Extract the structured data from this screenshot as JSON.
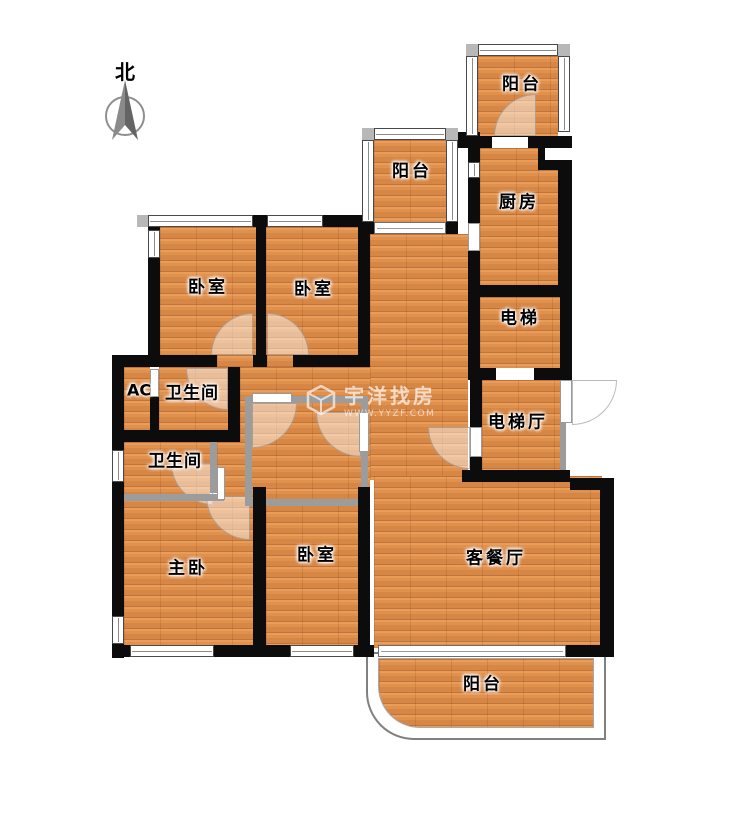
{
  "compass": {
    "label": "北"
  },
  "watermark": {
    "brand": "宇洋找房",
    "url": "WWW.YYZF.COM"
  },
  "rooms": {
    "balcony_top": {
      "label": "阳台"
    },
    "balcony_mid": {
      "label": "阳台"
    },
    "kitchen": {
      "label": "厨房"
    },
    "bedroom_left": {
      "label": "卧室"
    },
    "bedroom_mid": {
      "label": "卧室"
    },
    "elevator": {
      "label": "电梯"
    },
    "elevator_hall": {
      "label": "电梯厅"
    },
    "ac": {
      "label": "AC"
    },
    "bathroom_top": {
      "label": "卫生间"
    },
    "bathroom_bottom": {
      "label": "卫生间"
    },
    "master_bedroom": {
      "label": "主卧"
    },
    "bedroom_bottom": {
      "label": "卧室"
    },
    "living_dining": {
      "label": "客餐厅"
    },
    "balcony_bottom": {
      "label": "阳台"
    }
  },
  "colors": {
    "wall": "#0c0c0c",
    "partition": "#9c9c9c",
    "floor": "#e0914e",
    "watermark": "#ffffff"
  }
}
